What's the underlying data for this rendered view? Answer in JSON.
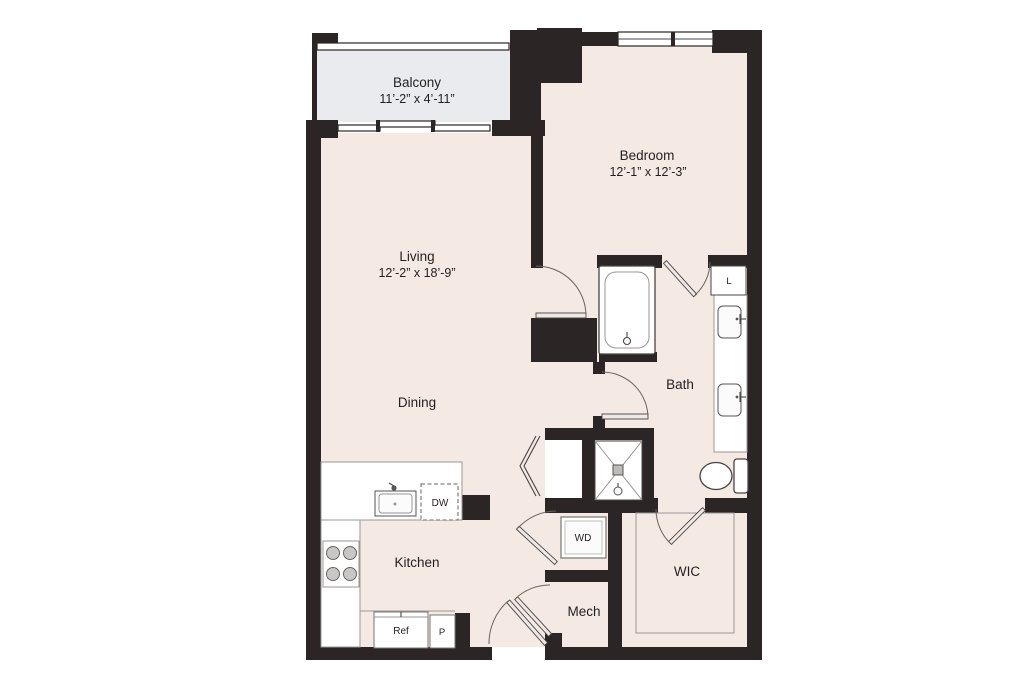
{
  "meta": {
    "title": "One-bedroom apartment floor plan"
  },
  "colors": {
    "wall": "#2b2625",
    "floor": "#f4e9e3",
    "balcony_floor": "#e9ebee",
    "fixture_white": "#ffffff",
    "text": "#231f20"
  },
  "rooms": {
    "balcony": {
      "name": "Balcony",
      "dims": "11’-2” x 4’-11”"
    },
    "living": {
      "name": "Living",
      "dims": "12’-2” x 18’-9”"
    },
    "dining": {
      "name": "Dining"
    },
    "bedroom": {
      "name": "Bedroom",
      "dims": "12’-1” x 12’-3”"
    },
    "bath": {
      "name": "Bath"
    },
    "kitchen": {
      "name": "Kitchen"
    },
    "wic": {
      "name": "WIC"
    },
    "mech": {
      "name": "Mech"
    }
  },
  "fixtures": {
    "washer_dryer": "WD",
    "dishwasher": "DW",
    "refrigerator": "Ref",
    "pantry": "P",
    "linen": "L"
  }
}
